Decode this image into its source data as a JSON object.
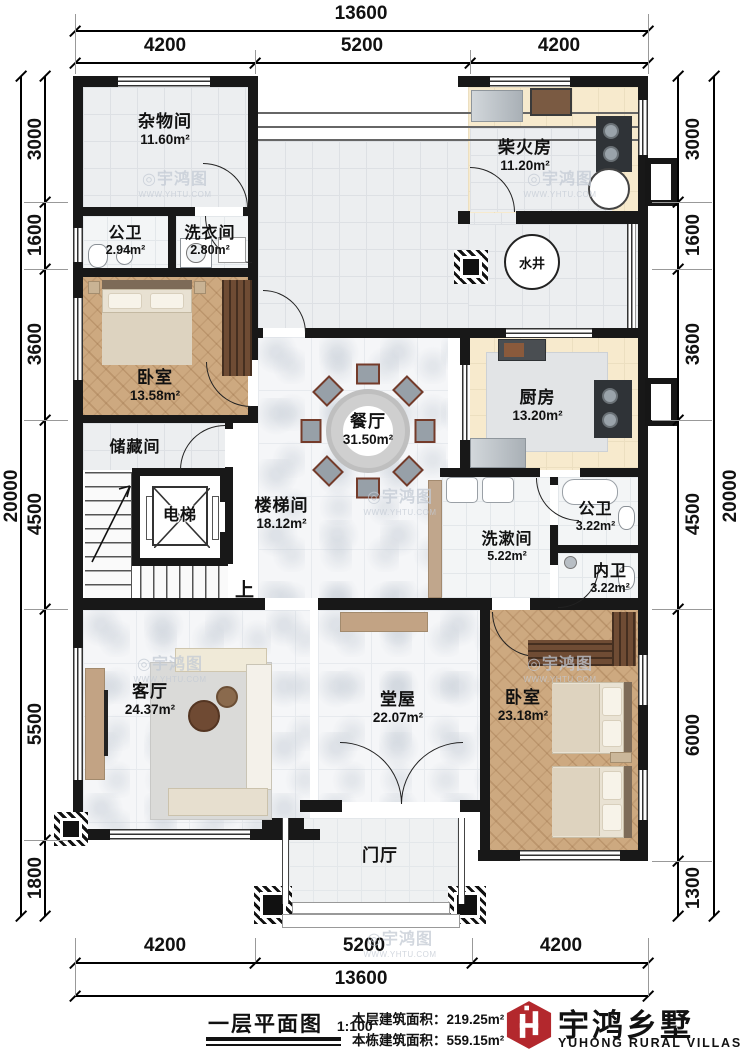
{
  "plan": {
    "rooms": [
      {
        "name": "杂物间",
        "area": "11.60m²"
      },
      {
        "name": "公卫",
        "area": "2.94m²"
      },
      {
        "name": "洗衣间",
        "area": "2.80m²"
      },
      {
        "name": "柴火房",
        "area": "11.20m²"
      },
      {
        "name": "卧室",
        "area": "13.58m²"
      },
      {
        "name": "储藏间",
        "area": ""
      },
      {
        "name": "电梯",
        "area": ""
      },
      {
        "name": "楼梯间",
        "area": "18.12m²"
      },
      {
        "name": "餐厅",
        "area": "31.50m²"
      },
      {
        "name": "厨房",
        "area": "13.20m²"
      },
      {
        "name": "公卫",
        "area": "3.22m²"
      },
      {
        "name": "洗漱间",
        "area": "5.22m²"
      },
      {
        "name": "内卫",
        "area": "3.22m²"
      },
      {
        "name": "客厅",
        "area": "24.37m²"
      },
      {
        "name": "堂屋",
        "area": "22.07m²"
      },
      {
        "name": "卧室",
        "area": "23.18m²"
      },
      {
        "name": "门厅",
        "area": ""
      }
    ],
    "annotations": {
      "well": "水井",
      "up": "上"
    },
    "dimensions": {
      "top_total": "13600",
      "top_segments": [
        "4200",
        "5200",
        "4200"
      ],
      "bottom_segments": [
        "4200",
        "5200",
        "4200"
      ],
      "bottom_total": "13600",
      "left_segments": [
        "3000",
        "1600",
        "3600",
        "4500",
        "5500",
        "1800"
      ],
      "left_total": "20000",
      "right_segments": [
        "3000",
        "1600",
        "3600",
        "4500",
        "6000",
        "1300"
      ],
      "right_total": "20000"
    },
    "wall_color": "#181818"
  },
  "footer": {
    "title": "一层平面图",
    "scale": "1:100",
    "floor_area_label": "本层建筑面积：",
    "floor_area_value": "219.25m²",
    "building_area_label": "本栋建筑面积：",
    "building_area_value": "559.15m²",
    "brand_cn": "宇鸿乡墅",
    "brand_en": "YUHONG RURAL VILLAS",
    "brand_color": "#b3282d"
  },
  "watermark": {
    "icon": "◎",
    "text": "宇鸿图",
    "url": "WWW.YHTU.COM"
  }
}
